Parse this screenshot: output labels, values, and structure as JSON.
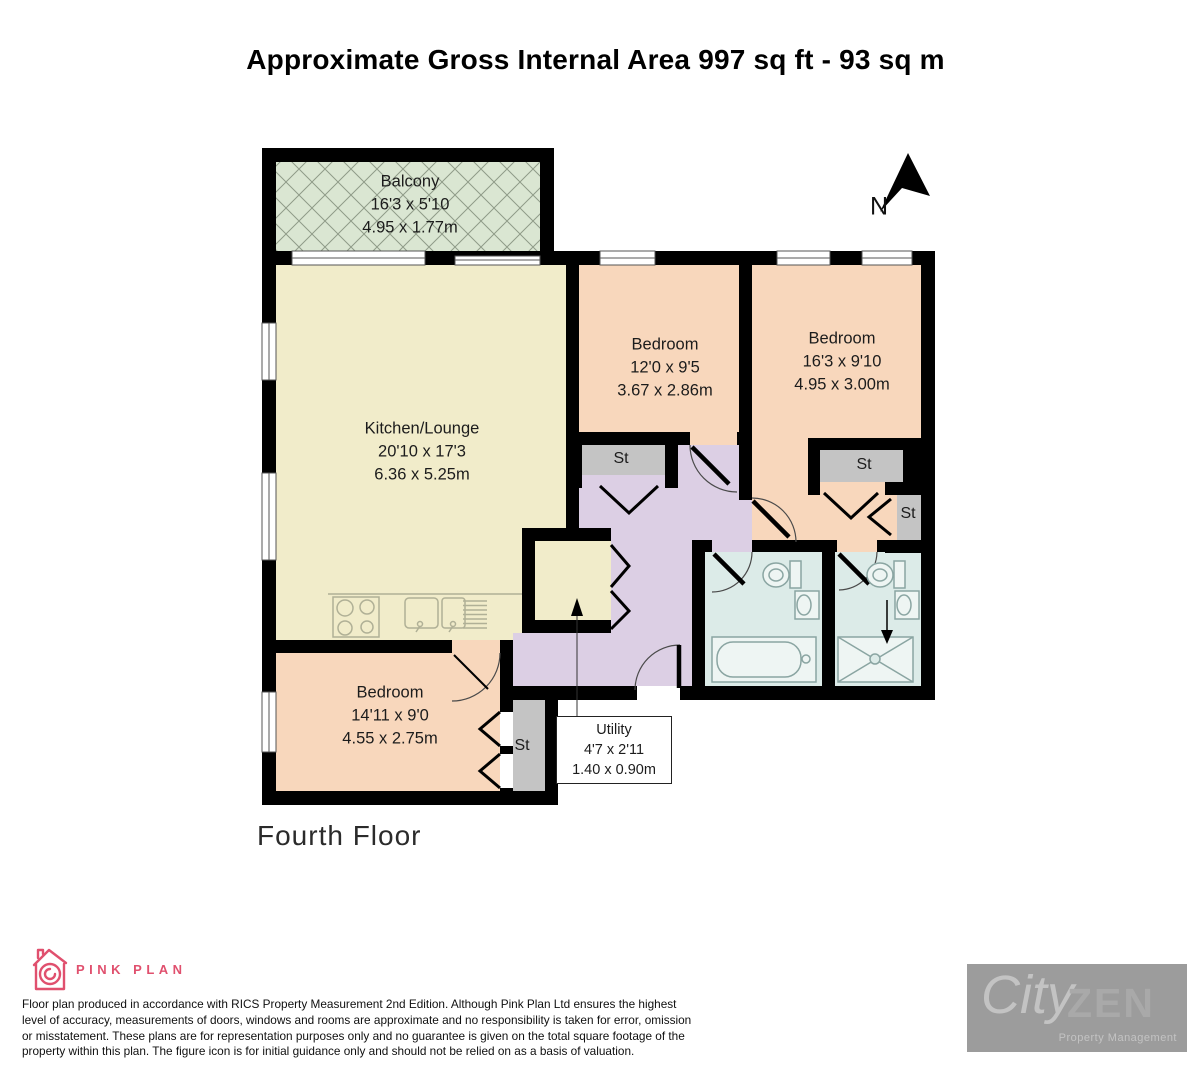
{
  "title": "Approximate Gross Internal Area 997 sq ft - 93 sq m",
  "north_label": "N",
  "floor_label": "Fourth Floor",
  "rooms": {
    "balcony": {
      "name": "Balcony",
      "dims_ft": "16'3 x 5'10",
      "dims_m": "4.95 x 1.77m"
    },
    "kitchen_lounge": {
      "name": "Kitchen/Lounge",
      "dims_ft": "20'10 x 17'3",
      "dims_m": "6.36 x 5.25m"
    },
    "bedroom_middle": {
      "name": "Bedroom",
      "dims_ft": "12'0 x 9'5",
      "dims_m": "3.67 x 2.86m"
    },
    "bedroom_right": {
      "name": "Bedroom",
      "dims_ft": "16'3 x 9'10",
      "dims_m": "4.95 x 3.00m"
    },
    "bedroom_bottom": {
      "name": "Bedroom",
      "dims_ft": "14'11 x 9'0",
      "dims_m": "4.55 x 2.75m"
    },
    "utility": {
      "name": "Utility",
      "dims_ft": "4'7 x 2'11",
      "dims_m": "1.40 x 0.90m"
    }
  },
  "storage_labels": [
    "St",
    "St",
    "St",
    "St"
  ],
  "footer": {
    "brand": "PINK PLAN",
    "disclaimer": "Floor plan produced in accordance with RICS Property Measurement 2nd Edition. Although Pink Plan Ltd ensures the highest level of accuracy, measurements of doors, windows and rooms are approximate and no responsibility is taken for error, omission or misstatement. These plans are for representation purposes only and no guarantee is given on the total square footage of the property within this plan. The figure icon is for initial guidance only and should not be relied on as a basis of valuation.",
    "agency": {
      "word1": "City",
      "word2": "ZEN",
      "tagline": "Property Management"
    }
  },
  "colors": {
    "wall": "#000000",
    "balcony_green": "#dae6d2",
    "kitchen_cream": "#f1ecca",
    "bedroom_peach": "#f8d7bc",
    "hallway_lilac": "#dccfe4",
    "bathroom_blue": "#dcebe8",
    "storage_gray": "#c4c4c4",
    "brand_pink": "#e0506e",
    "agency_gray": "#9c9c9c"
  }
}
